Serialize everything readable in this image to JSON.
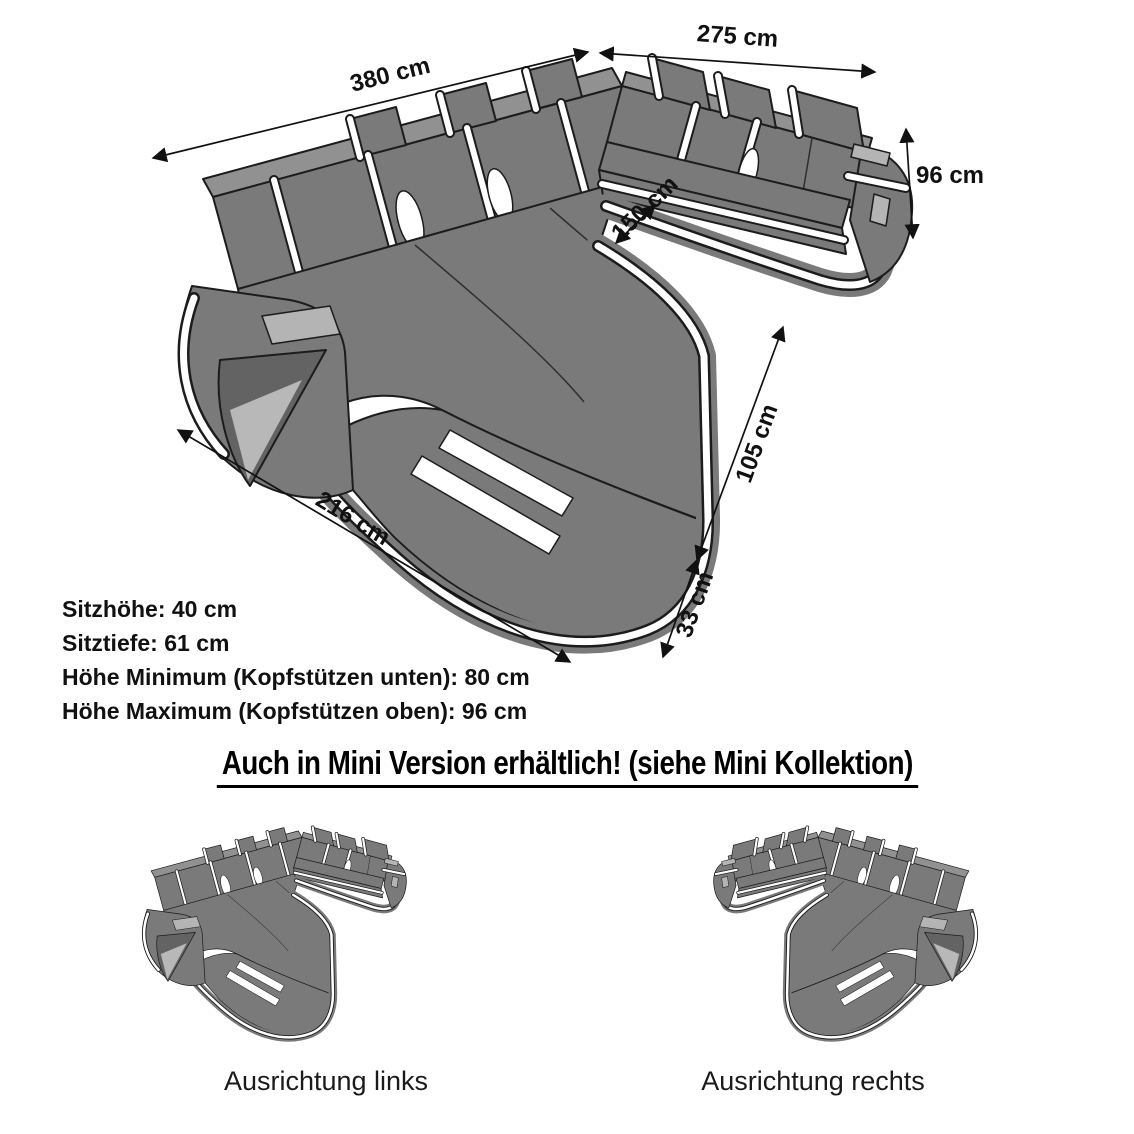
{
  "illustration": {
    "description": "Technical drawing of a U-shaped sectional sofa (Wohnlandschaft) with LED trim, shown isometrically with dimension arrows",
    "colors": {
      "sofa_body": "#7a7a7a",
      "sofa_top": "#919191",
      "outline": "#1c1c1c",
      "accent_stripe": "#ffffff",
      "led_glow": "#b4b4b4",
      "arm_window": "#636363"
    }
  },
  "dimensions": [
    {
      "id": "back-left-width",
      "label": "380 cm"
    },
    {
      "id": "back-right-width",
      "label": "275 cm"
    },
    {
      "id": "height",
      "label": "96 cm"
    },
    {
      "id": "inner-clearance",
      "label": "150 cm"
    },
    {
      "id": "chaise-length",
      "label": "216 cm"
    },
    {
      "id": "front-right-length",
      "label": "105 cm"
    },
    {
      "id": "foot-depth",
      "label": "33 cm"
    }
  ],
  "specs": {
    "lines": [
      "Sitzhöhe: 40 cm",
      "Sitztiefe: 61 cm",
      "Höhe Minimum (Kopfstützen unten): 80 cm",
      "Höhe Maximum (Kopfstützen oben): 96 cm"
    ]
  },
  "mini_section": {
    "heading": "Auch in Mini Version erhältlich! (siehe Mini Kollektion)",
    "variants": [
      {
        "label": "Ausrichtung links"
      },
      {
        "label": "Ausrichtung rechts"
      }
    ]
  }
}
